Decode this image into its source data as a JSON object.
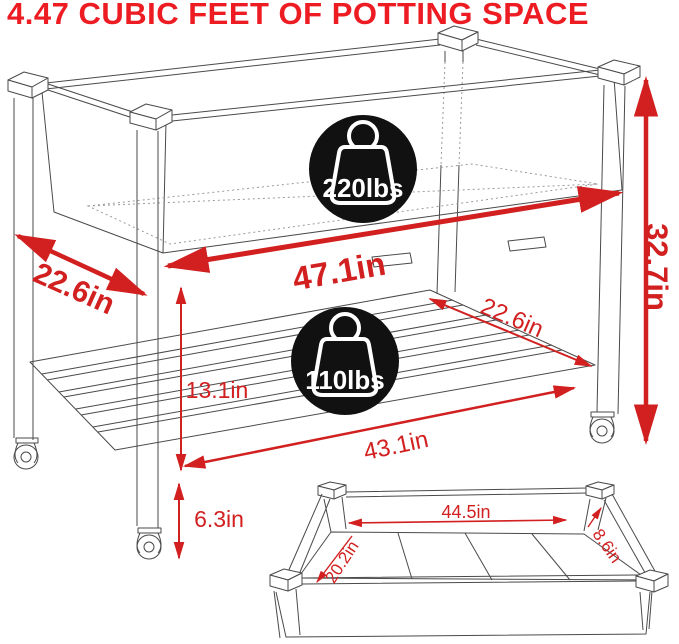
{
  "title": "4.47 CUBIC FEET OF POTTING SPACE",
  "colors": {
    "title_red": "#ed1b22",
    "dimension_red": "#d22020",
    "badge_black": "#111111",
    "line_gray": "#4a4a4a",
    "background": "#ffffff"
  },
  "badges": {
    "top_capacity": "220lbs",
    "shelf_capacity": "110lbs"
  },
  "dims": {
    "depth_top": "22.6in",
    "width_top": "47.1in",
    "height_total": "32.7in",
    "shelf_gap": "13.1in",
    "shelf_depth": "22.6in",
    "shelf_width": "43.1in",
    "ground_clearance": "6.3in",
    "inner_length": "44.5in",
    "inner_depth": "8.6in",
    "inner_width": "20.2in"
  }
}
